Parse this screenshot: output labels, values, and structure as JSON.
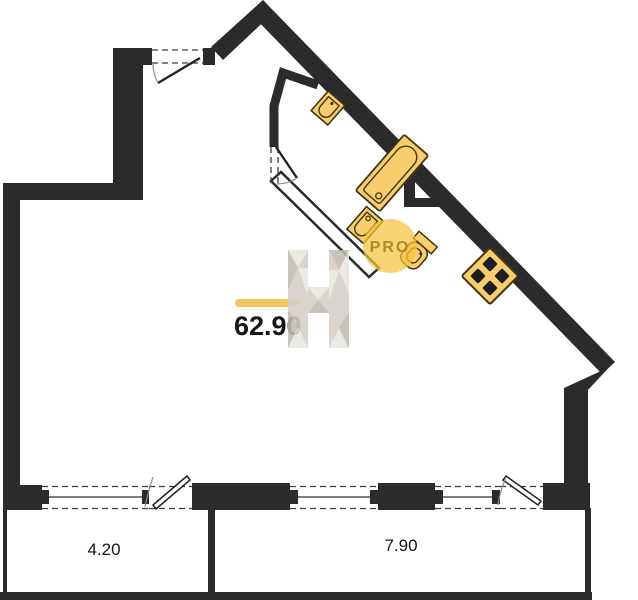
{
  "plan": {
    "type": "apartment-floor-plan",
    "area_label": "62.90",
    "balcony_left_label": "4.20",
    "balcony_right_label": "7.90",
    "watermark": {
      "letter": "H",
      "badge": "PRO"
    },
    "fixtures": [
      "sink",
      "bathtub",
      "washbasin",
      "toilet",
      "stove"
    ],
    "colors": {
      "wall": "#2b2b2b",
      "fixture_fill": "#f8cd6d",
      "fixture_stroke": "#413511",
      "burner": "#1e1e1e",
      "accent_bar": "#f2c75f",
      "label": "#161616",
      "watermark_gray": "#d5cfc8",
      "watermark_gray_light": "#e9e6e1",
      "watermark_gray_dark": "#c2bbb2",
      "pro_circle": "#f5c33e",
      "pro_text": "#a87b1a"
    }
  }
}
